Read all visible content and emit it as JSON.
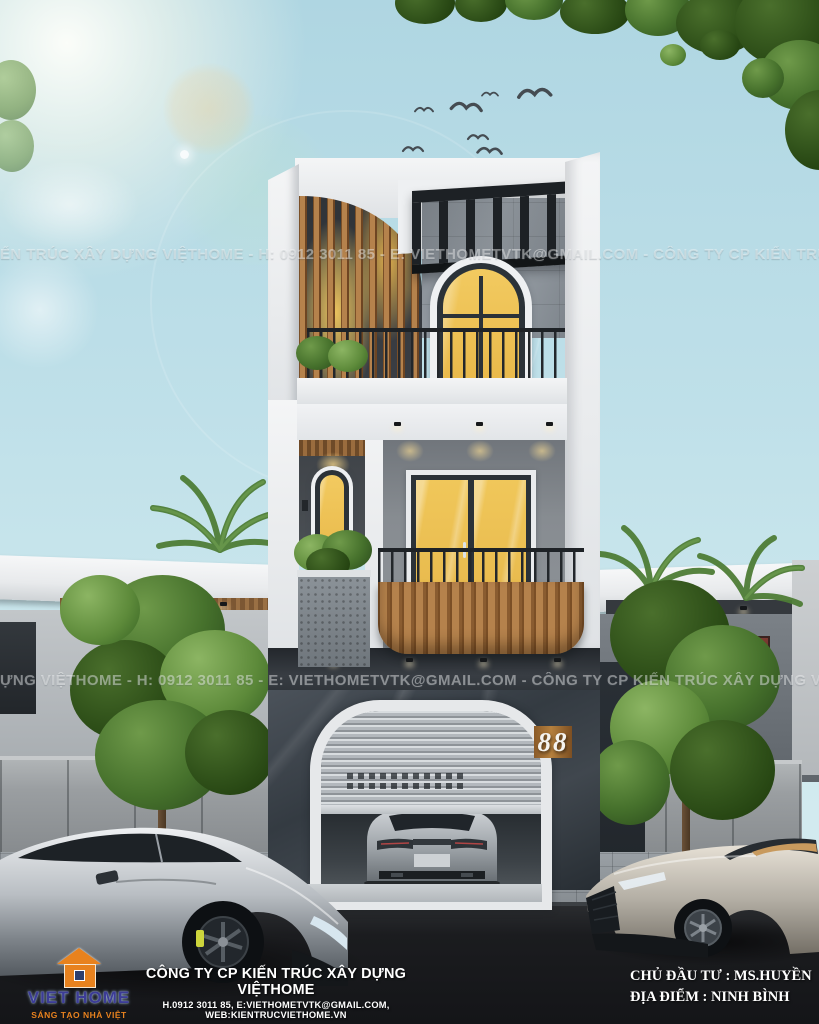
{
  "meta": {
    "type": "3d-architectural-render",
    "subject": "3-storey modern townhouse exterior, front elevation, with garage, two cars and street"
  },
  "colors": {
    "sky_top": "#afd6e2",
    "sky_bottom": "#d8edf1",
    "wood_accent": "#b5824c",
    "window_glow_yellow": "#eec258",
    "dark_frame": "#2b3238",
    "marble_dark": "#3c434a",
    "white_wall": "#f4f5f6",
    "road_dark": "#17181b",
    "brand_orange": "#e8821e",
    "brand_blue": "#3c3c96"
  },
  "watermarks": {
    "band1": "ẾN TRÚC XÂY DỰNG VIỆTHOME  -  H: 0912 3011 85  -  E: VIETHOMETVTK@GMAIL.COM  -  CÔNG TY CP KIẾN TRÚC XÂY DỰNG VIỆTHOME  -  H: 0912 3011 85",
    "band2": "ỰNG VIỆTHOME  -  H: 0912 3011 85  -  E: VIETHOMETVTK@GMAIL.COM  -  CÔNG TY CP KIẾN TRÚC XÂY DỰNG VIỆTHOME  -  H: 0912 3011 85  -  E: V"
  },
  "building": {
    "house_number": "88"
  },
  "footer": {
    "brand": "VIET HOME",
    "tagline": "SÁNG TẠO NHÀ VIỆT",
    "company_name": "CÔNG TY CP KIẾN TRÚC XÂY DỰNG VIỆTHOME",
    "company_contact": "H.0912 3011 85, E:VIETHOMETVTK@GMAIL.COM, WEB:KIENTRUCVIETHOME.VN",
    "investor": "CHỦ ĐẦU TƯ : MS.HUYỀN",
    "location": "ĐỊA ĐIỂM : NINH BÌNH"
  }
}
